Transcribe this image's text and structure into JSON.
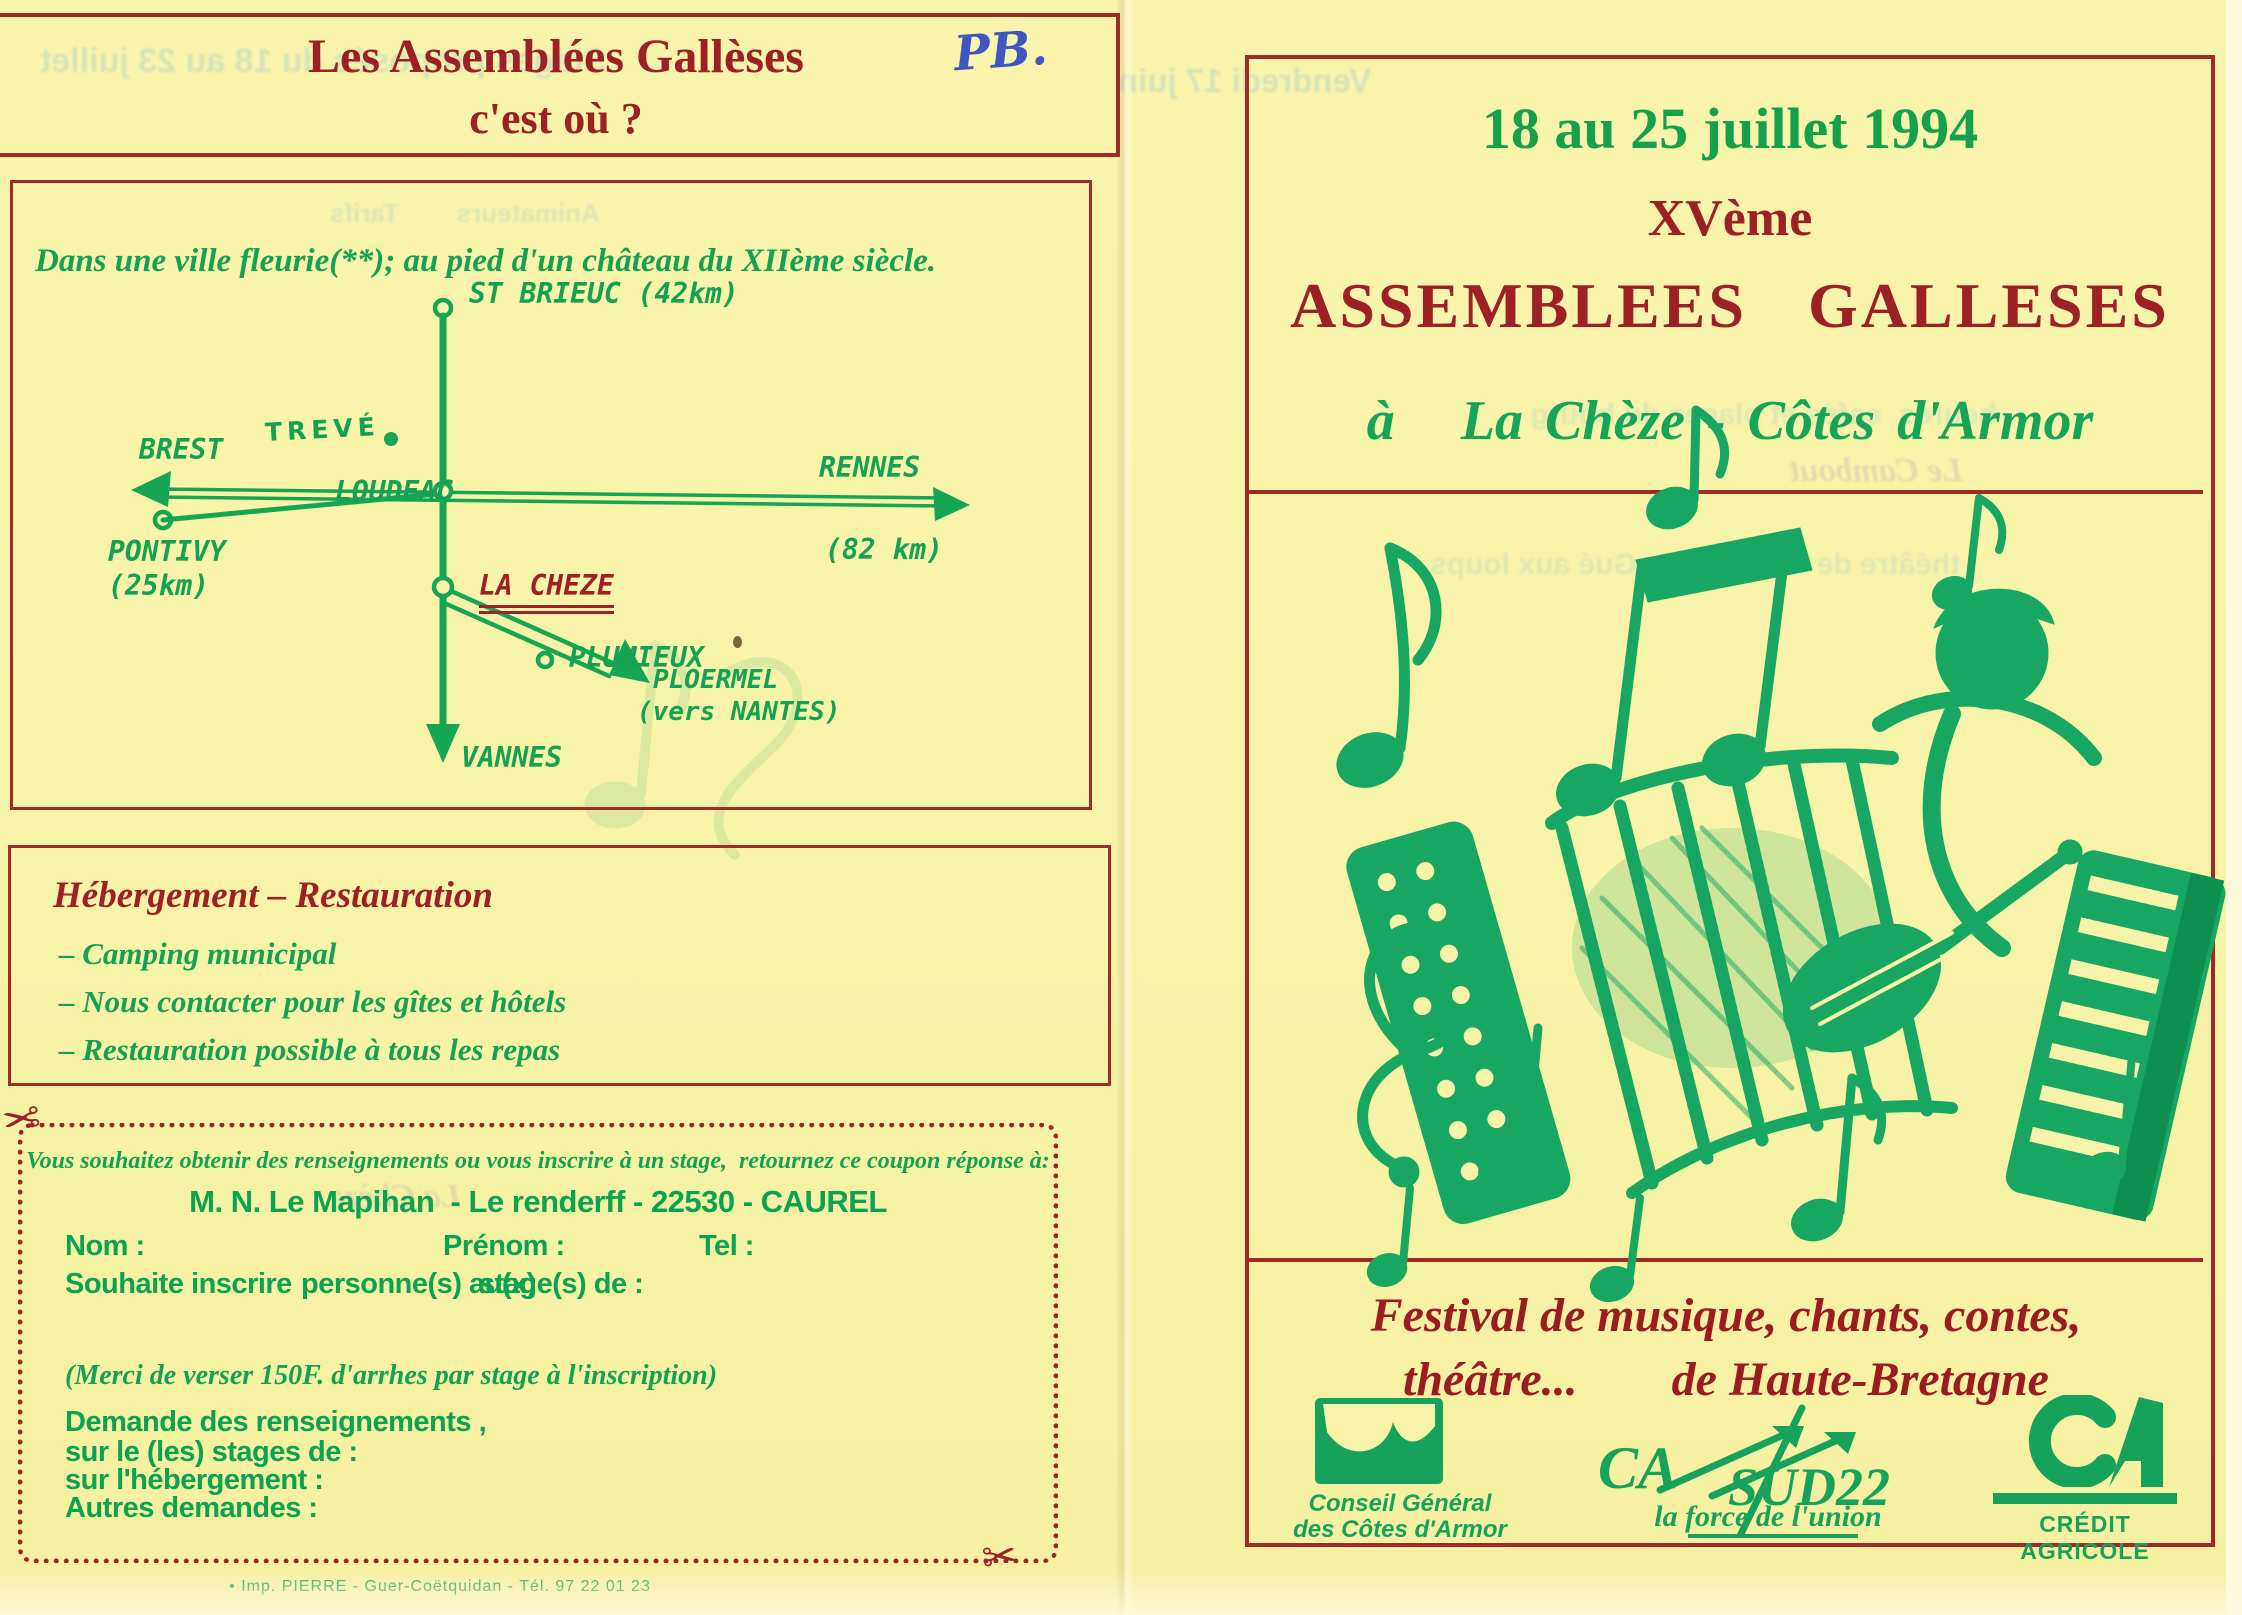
{
  "colors": {
    "background": "#f7f3a8",
    "maroon": "#9c2024",
    "green": "#14a153",
    "illustration_green": "#18a762",
    "handwriting_blue": "#3d56c0"
  },
  "left": {
    "title": {
      "line1": "Les Assemblées Gallèses",
      "line2": "c'est où ?",
      "handwritten": "PB."
    },
    "map": {
      "caption": "Dans une ville fleurie(**); au pied d'un château du XIIème siècle.",
      "labels": {
        "st_brieuc": "ST BRIEUC (42km)",
        "treve": "TREVÉ",
        "brest": "BREST",
        "loudeac": "LOUDEAC",
        "rennes": "RENNES",
        "rennes_km": "(82 km)",
        "pontivy": "PONTIVY",
        "pontivy_km": "(25km)",
        "la_cheze": "LA CHEZE",
        "plumieux": "PLUMIEUX",
        "ploermel": "PLOERMEL",
        "ploermel_sub": "(vers NANTES)",
        "vannes": "VANNES"
      }
    },
    "hebergement": {
      "title": "Hébergement – Restauration",
      "items": [
        "– Camping municipal",
        "– Nous contacter pour les gîtes et hôtels",
        "– Restauration possible à tous les repas"
      ]
    },
    "coupon": {
      "intro": "Vous souhaitez obtenir des renseignements ou vous inscrire à un stage,  retournez ce coupon réponse à:",
      "address": "M. N. Le Mapihan  - Le renderff - 22530 - CAUREL",
      "nom": "Nom :",
      "prenom": "Prénom :",
      "tel": "Tel :",
      "inscrire_a": "Souhaite inscrire",
      "inscrire_b": "personne(s) au(x)",
      "inscrire_c": "stage(s) de :",
      "arrhes": "(Merci de verser 150F. d'arrhes par stage à l'inscription)",
      "demande": "Demande des renseignements ,",
      "stages": "sur le (les) stages de :",
      "hebergement": "sur l'hébergement :",
      "autres": "Autres demandes :"
    },
    "imprint": "• Imp. PIERRE - Guer-Coëtquidan - Tél. 97 22 01 23"
  },
  "right": {
    "dates": "18 au 25 juillet 1994",
    "edition": "XVème",
    "title": "ASSEMBLEES GALLESES",
    "location_prefix": "à",
    "location": "La Chèze - Côtes d'Armor",
    "festival_line1": "Festival de musique, chants, contes,",
    "festival_line2a": "théâtre...",
    "festival_line2b": "de Haute-Bretagne",
    "logos": {
      "conseil_line1": "Conseil Général",
      "conseil_line2": "des Côtes d'Armor",
      "capsud_ca": "CA",
      "capsud_sud": "SUD22",
      "capsud_tagline": "la force de l'union",
      "credit_label": "CRÉDIT AGRICOLE"
    }
  },
  "bleedthrough": {
    "stages_top": "Stages proposés du 18 au 23 juillet",
    "vendredi": "Vendredi 17 juin",
    "map_ghost": "Animateurs        Tarifs",
    "coupon_ghost": "La Chèze",
    "right_places": "heures  cafés et places du bourg",
    "right_theatre": "théâtre de verdure  du Gué aux loups",
    "right_cambout": "Le Cambout"
  }
}
